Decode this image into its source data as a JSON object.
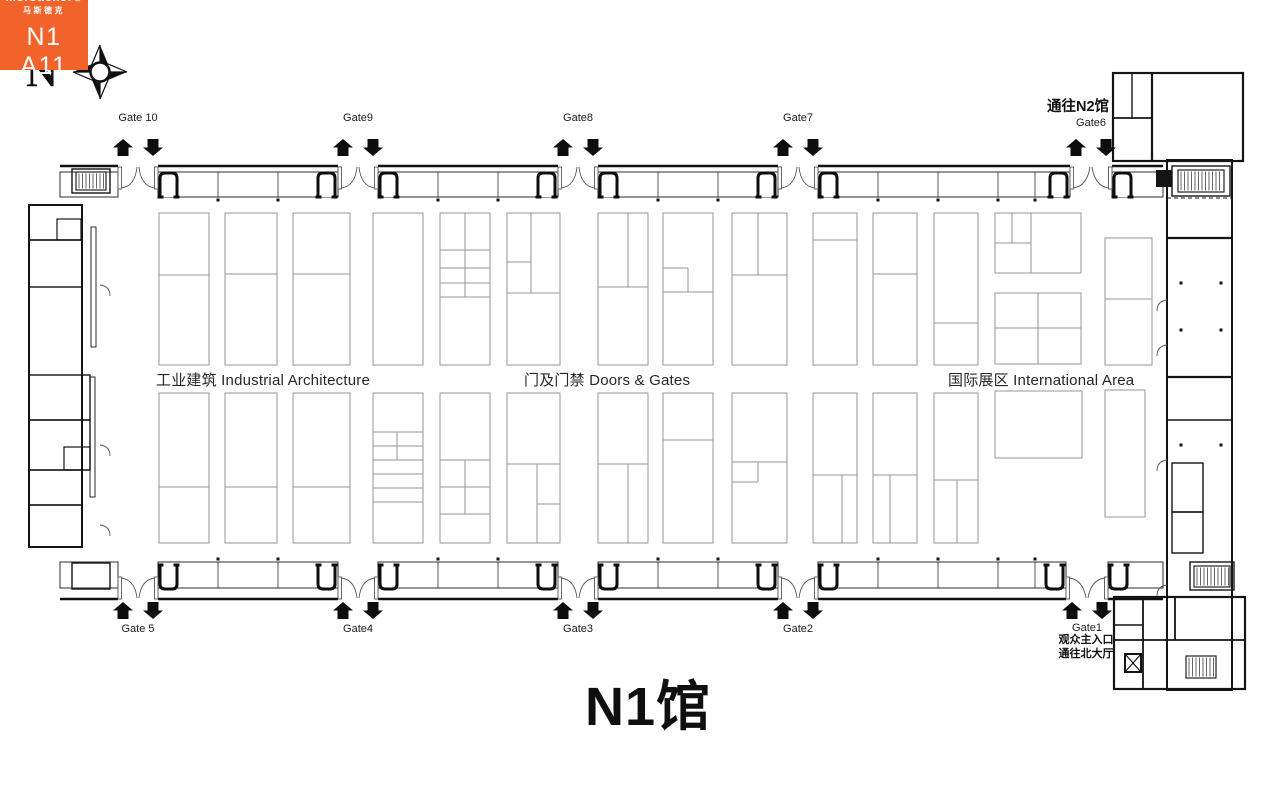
{
  "title": {
    "text": "N1馆",
    "x": 648,
    "y": 662
  },
  "compass": {
    "letter": "N",
    "x": 26,
    "y": 44
  },
  "labels": {
    "to_n2": {
      "text": "通往N2馆",
      "x": 1078,
      "y": 95
    },
    "gate1_note": {
      "x": 1086,
      "y": 634,
      "line1": "观众主入口",
      "line2": "通往北大厅"
    }
  },
  "areas": [
    {
      "text": "工业建筑 Industrial Architecture",
      "x": 156,
      "y": 369
    },
    {
      "text": "门及门禁 Doors & Gates",
      "x": 524,
      "y": 369
    },
    {
      "text": "国际展区 International Area",
      "x": 948,
      "y": 369
    }
  ],
  "highlight_booth": {
    "brand": "Mörsdekor®",
    "brand_zh": "马斯德克",
    "booth_no": "N1 A11",
    "color": "#F2632C",
    "x": 994,
    "y": 474,
    "w": 88,
    "h": 70
  },
  "gates": {
    "top": [
      {
        "label": "Gate 10",
        "cx": 138,
        "open": [
          118,
          158
        ],
        "label_y": 112
      },
      {
        "label": "Gate9",
        "cx": 358,
        "open": [
          338,
          378
        ],
        "label_y": 112
      },
      {
        "label": "Gate8",
        "cx": 578,
        "open": [
          558,
          598
        ],
        "label_y": 112
      },
      {
        "label": "Gate7",
        "cx": 798,
        "open": [
          778,
          818
        ],
        "label_y": 112
      },
      {
        "label": "Gate6",
        "cx": 1091,
        "open": [
          1070,
          1112
        ],
        "label_y": 117
      }
    ],
    "bottom": [
      {
        "label": "Gate 5",
        "cx": 138,
        "open": [
          118,
          158
        ],
        "label_y": 623
      },
      {
        "label": "Gate4",
        "cx": 358,
        "open": [
          338,
          378
        ],
        "label_y": 623
      },
      {
        "label": "Gate3",
        "cx": 578,
        "open": [
          558,
          598
        ],
        "label_y": 623
      },
      {
        "label": "Gate2",
        "cx": 798,
        "open": [
          778,
          818
        ],
        "label_y": 623
      },
      {
        "label": "Gate1",
        "cx": 1087,
        "open": [
          1066,
          1108
        ],
        "label_y": 622
      }
    ]
  },
  "geometry": {
    "colors": {
      "wall": "#141414",
      "booth": "#949494",
      "band": "#2e2e2e"
    },
    "gate_arrows_y": {
      "top": 139,
      "bottom": 602
    },
    "booths": [
      {
        "x": 159,
        "y": 213,
        "w": 50,
        "h": 152,
        "lines": [
          [
            159,
            275,
            209,
            275
          ]
        ]
      },
      {
        "x": 225,
        "y": 213,
        "w": 52,
        "h": 152,
        "lines": [
          [
            225,
            274,
            277,
            274
          ]
        ]
      },
      {
        "x": 293,
        "y": 213,
        "w": 57,
        "h": 152,
        "lines": [
          [
            293,
            274,
            350,
            274
          ]
        ]
      },
      {
        "x": 373,
        "y": 213,
        "w": 50,
        "h": 152,
        "lines": []
      },
      {
        "x": 440,
        "y": 213,
        "w": 50,
        "h": 152,
        "lines": [
          [
            465,
            213,
            465,
            297
          ],
          [
            440,
            250,
            490,
            250
          ],
          [
            440,
            268,
            490,
            268
          ],
          [
            440,
            283,
            490,
            283
          ],
          [
            440,
            297,
            490,
            297
          ]
        ]
      },
      {
        "x": 507,
        "y": 213,
        "w": 53,
        "h": 152,
        "lines": [
          [
            531,
            213,
            531,
            293
          ],
          [
            507,
            262,
            531,
            262
          ],
          [
            507,
            293,
            560,
            293
          ]
        ]
      },
      {
        "x": 598,
        "y": 213,
        "w": 50,
        "h": 152,
        "lines": [
          [
            628,
            213,
            628,
            287
          ],
          [
            598,
            287,
            648,
            287
          ]
        ]
      },
      {
        "x": 663,
        "y": 213,
        "w": 50,
        "h": 152,
        "lines": [
          [
            663,
            268,
            688,
            268
          ],
          [
            688,
            268,
            688,
            292
          ],
          [
            663,
            292,
            713,
            292
          ]
        ]
      },
      {
        "x": 732,
        "y": 213,
        "w": 55,
        "h": 152,
        "lines": [
          [
            758,
            213,
            758,
            275
          ],
          [
            732,
            275,
            787,
            275
          ]
        ]
      },
      {
        "x": 813,
        "y": 213,
        "w": 44,
        "h": 152,
        "lines": [
          [
            813,
            240,
            857,
            240
          ]
        ]
      },
      {
        "x": 873,
        "y": 213,
        "w": 44,
        "h": 152,
        "lines": [
          [
            873,
            274,
            917,
            274
          ]
        ]
      },
      {
        "x": 934,
        "y": 213,
        "w": 44,
        "h": 152,
        "lines": [
          [
            934,
            323,
            978,
            323
          ]
        ]
      },
      {
        "x": 995,
        "y": 213,
        "w": 86,
        "h": 60,
        "lines": [
          [
            1012,
            213,
            1012,
            243
          ],
          [
            995,
            243,
            1031,
            243
          ],
          [
            1031,
            213,
            1031,
            273
          ]
        ]
      },
      {
        "x": 995,
        "y": 293,
        "w": 86,
        "h": 71,
        "lines": [
          [
            1038,
            293,
            1038,
            364
          ],
          [
            995,
            328,
            1081,
            328
          ]
        ]
      },
      {
        "x": 1105,
        "y": 238,
        "w": 47,
        "h": 127,
        "lines": [
          [
            1105,
            299,
            1152,
            299
          ]
        ]
      },
      {
        "x": 159,
        "y": 393,
        "w": 50,
        "h": 150,
        "lines": [
          [
            159,
            487,
            209,
            487
          ]
        ]
      },
      {
        "x": 225,
        "y": 393,
        "w": 52,
        "h": 150,
        "lines": [
          [
            225,
            487,
            277,
            487
          ]
        ]
      },
      {
        "x": 293,
        "y": 393,
        "w": 57,
        "h": 150,
        "lines": [
          [
            293,
            487,
            350,
            487
          ]
        ]
      },
      {
        "x": 373,
        "y": 393,
        "w": 50,
        "h": 150,
        "lines": [
          [
            373,
            432,
            423,
            432
          ],
          [
            373,
            446,
            423,
            446
          ],
          [
            373,
            460,
            423,
            460
          ],
          [
            373,
            474,
            423,
            474
          ],
          [
            373,
            488,
            423,
            488
          ],
          [
            373,
            502,
            423,
            502
          ],
          [
            397,
            432,
            397,
            460
          ]
        ]
      },
      {
        "x": 440,
        "y": 393,
        "w": 50,
        "h": 150,
        "lines": [
          [
            440,
            460,
            490,
            460
          ],
          [
            440,
            487,
            490,
            487
          ],
          [
            440,
            514,
            490,
            514
          ],
          [
            465,
            460,
            465,
            514
          ]
        ]
      },
      {
        "x": 507,
        "y": 393,
        "w": 53,
        "h": 150,
        "lines": [
          [
            507,
            464,
            560,
            464
          ],
          [
            537,
            464,
            537,
            543
          ],
          [
            537,
            504,
            560,
            504
          ]
        ]
      },
      {
        "x": 598,
        "y": 393,
        "w": 50,
        "h": 150,
        "lines": [
          [
            598,
            464,
            648,
            464
          ],
          [
            628,
            464,
            628,
            543
          ]
        ]
      },
      {
        "x": 663,
        "y": 393,
        "w": 50,
        "h": 150,
        "lines": [
          [
            663,
            440,
            713,
            440
          ]
        ]
      },
      {
        "x": 732,
        "y": 393,
        "w": 55,
        "h": 150,
        "lines": [
          [
            732,
            462,
            787,
            462
          ],
          [
            758,
            462,
            758,
            482
          ],
          [
            732,
            482,
            758,
            482
          ]
        ]
      },
      {
        "x": 813,
        "y": 393,
        "w": 44,
        "h": 150,
        "lines": [
          [
            813,
            475,
            857,
            475
          ],
          [
            842,
            475,
            842,
            543
          ]
        ]
      },
      {
        "x": 873,
        "y": 393,
        "w": 44,
        "h": 150,
        "lines": [
          [
            873,
            475,
            917,
            475
          ],
          [
            890,
            475,
            890,
            543
          ]
        ]
      },
      {
        "x": 934,
        "y": 393,
        "w": 44,
        "h": 150,
        "lines": [
          [
            934,
            480,
            978,
            480
          ],
          [
            957,
            480,
            957,
            543
          ]
        ]
      },
      {
        "x": 995,
        "y": 391,
        "w": 87,
        "h": 67,
        "lines": []
      },
      {
        "x": 1105,
        "y": 390,
        "w": 40,
        "h": 127,
        "lines": []
      }
    ],
    "bands": {
      "top": {
        "y": 172,
        "h": 25,
        "wall_y": 166,
        "runs": [
          [
            60,
            118
          ],
          [
            158,
            338
          ],
          [
            378,
            558
          ],
          [
            598,
            778
          ],
          [
            818,
            1070
          ],
          [
            1112,
            1163
          ]
        ],
        "dividers": [
          218,
          278,
          438,
          498,
          658,
          718,
          878,
          938,
          998,
          1035
        ]
      },
      "bottom": {
        "y": 562,
        "h": 26,
        "wall_y": 599,
        "runs": [
          [
            60,
            118
          ],
          [
            158,
            338
          ],
          [
            378,
            558
          ],
          [
            598,
            778
          ],
          [
            818,
            1066
          ],
          [
            1108,
            1163
          ]
        ],
        "dividers": [
          218,
          278,
          438,
          498,
          658,
          718,
          878,
          938,
          998,
          1035
        ]
      }
    },
    "udoors": {
      "top": [
        160,
        318,
        380,
        538,
        600,
        758,
        820,
        1050,
        1114
      ],
      "bottom": [
        160,
        318,
        380,
        538,
        600,
        758,
        820,
        1046,
        1110
      ]
    },
    "wall_rects": [
      [
        29,
        205,
        53,
        342,
        2
      ],
      [
        29,
        205,
        53,
        35,
        1.4
      ],
      [
        29,
        240,
        53,
        47,
        1.4
      ],
      [
        57,
        219,
        24,
        21,
        1.2
      ],
      [
        29,
        375,
        61,
        45,
        1.4
      ],
      [
        29,
        420,
        61,
        50,
        1.4
      ],
      [
        64,
        447,
        26,
        23,
        1.2
      ],
      [
        29,
        470,
        53,
        35,
        1.4
      ],
      [
        29,
        505,
        53,
        42,
        1.4
      ],
      [
        91,
        227,
        5,
        120,
        0.9
      ],
      [
        90,
        377,
        5,
        120,
        0.9
      ],
      [
        72,
        169,
        38,
        24,
        1.4
      ],
      [
        72,
        563,
        38,
        26,
        1.4
      ],
      [
        1167,
        160,
        65,
        530,
        2
      ],
      [
        1172,
        166,
        58,
        30,
        1.4
      ],
      [
        1172,
        463,
        31,
        49,
        1.4
      ],
      [
        1172,
        512,
        31,
        41,
        1.4
      ],
      [
        1190,
        562,
        44,
        28,
        1.4
      ],
      [
        1113,
        73,
        130,
        88,
        2.2
      ],
      [
        1114,
        597,
        131,
        92,
        2.2
      ]
    ],
    "wall_lines": [
      [
        1152,
        73,
        1152,
        161,
        2.2
      ],
      [
        1113,
        118,
        1152,
        118,
        1.8
      ],
      [
        1132,
        73,
        1132,
        118,
        1.4
      ],
      [
        1167,
        238,
        1232,
        238,
        2.2
      ],
      [
        1167,
        377,
        1232,
        377,
        2.2
      ],
      [
        1167,
        420,
        1232,
        420,
        1.4
      ],
      [
        1143,
        597,
        1143,
        689,
        1.8
      ],
      [
        1175,
        597,
        1175,
        640,
        1.8
      ],
      [
        1114,
        640,
        1245,
        640,
        1.8
      ],
      [
        1114,
        625,
        1143,
        625,
        1.4
      ]
    ],
    "dashed_lines": [
      [
        1167,
        198,
        1232,
        198
      ]
    ],
    "stairs": [
      [
        76,
        172,
        30,
        18
      ],
      [
        1178,
        170,
        46,
        22
      ],
      [
        1194,
        566,
        36,
        21
      ],
      [
        1186,
        656,
        30,
        22
      ]
    ],
    "dots": [
      [
        218,
        200
      ],
      [
        278,
        200
      ],
      [
        438,
        200
      ],
      [
        498,
        200
      ],
      [
        658,
        200
      ],
      [
        718,
        200
      ],
      [
        878,
        200
      ],
      [
        938,
        200
      ],
      [
        998,
        200
      ],
      [
        1035,
        200
      ],
      [
        218,
        559
      ],
      [
        278,
        559
      ],
      [
        438,
        559
      ],
      [
        498,
        559
      ],
      [
        658,
        559
      ],
      [
        718,
        559
      ],
      [
        878,
        559
      ],
      [
        938,
        559
      ],
      [
        998,
        559
      ],
      [
        1035,
        559
      ],
      [
        1181,
        283
      ],
      [
        1221,
        283
      ],
      [
        1181,
        330
      ],
      [
        1221,
        330
      ],
      [
        1181,
        445
      ],
      [
        1221,
        445
      ]
    ],
    "dark_rects": [
      [
        1156,
        170,
        16,
        17
      ]
    ],
    "xbox": [
      1125,
      654,
      16,
      18
    ],
    "door_arcs": [
      [
        100,
        285,
        110,
        286,
        110,
        296
      ],
      [
        100,
        445,
        110,
        446,
        110,
        456
      ],
      [
        100,
        525,
        110,
        526,
        110,
        536
      ],
      [
        1167,
        300,
        1157,
        301,
        1157,
        311
      ],
      [
        1167,
        345,
        1157,
        346,
        1157,
        356
      ],
      [
        1167,
        460,
        1157,
        461,
        1157,
        471
      ],
      [
        1167,
        585,
        1157,
        586,
        1157,
        596
      ]
    ]
  }
}
